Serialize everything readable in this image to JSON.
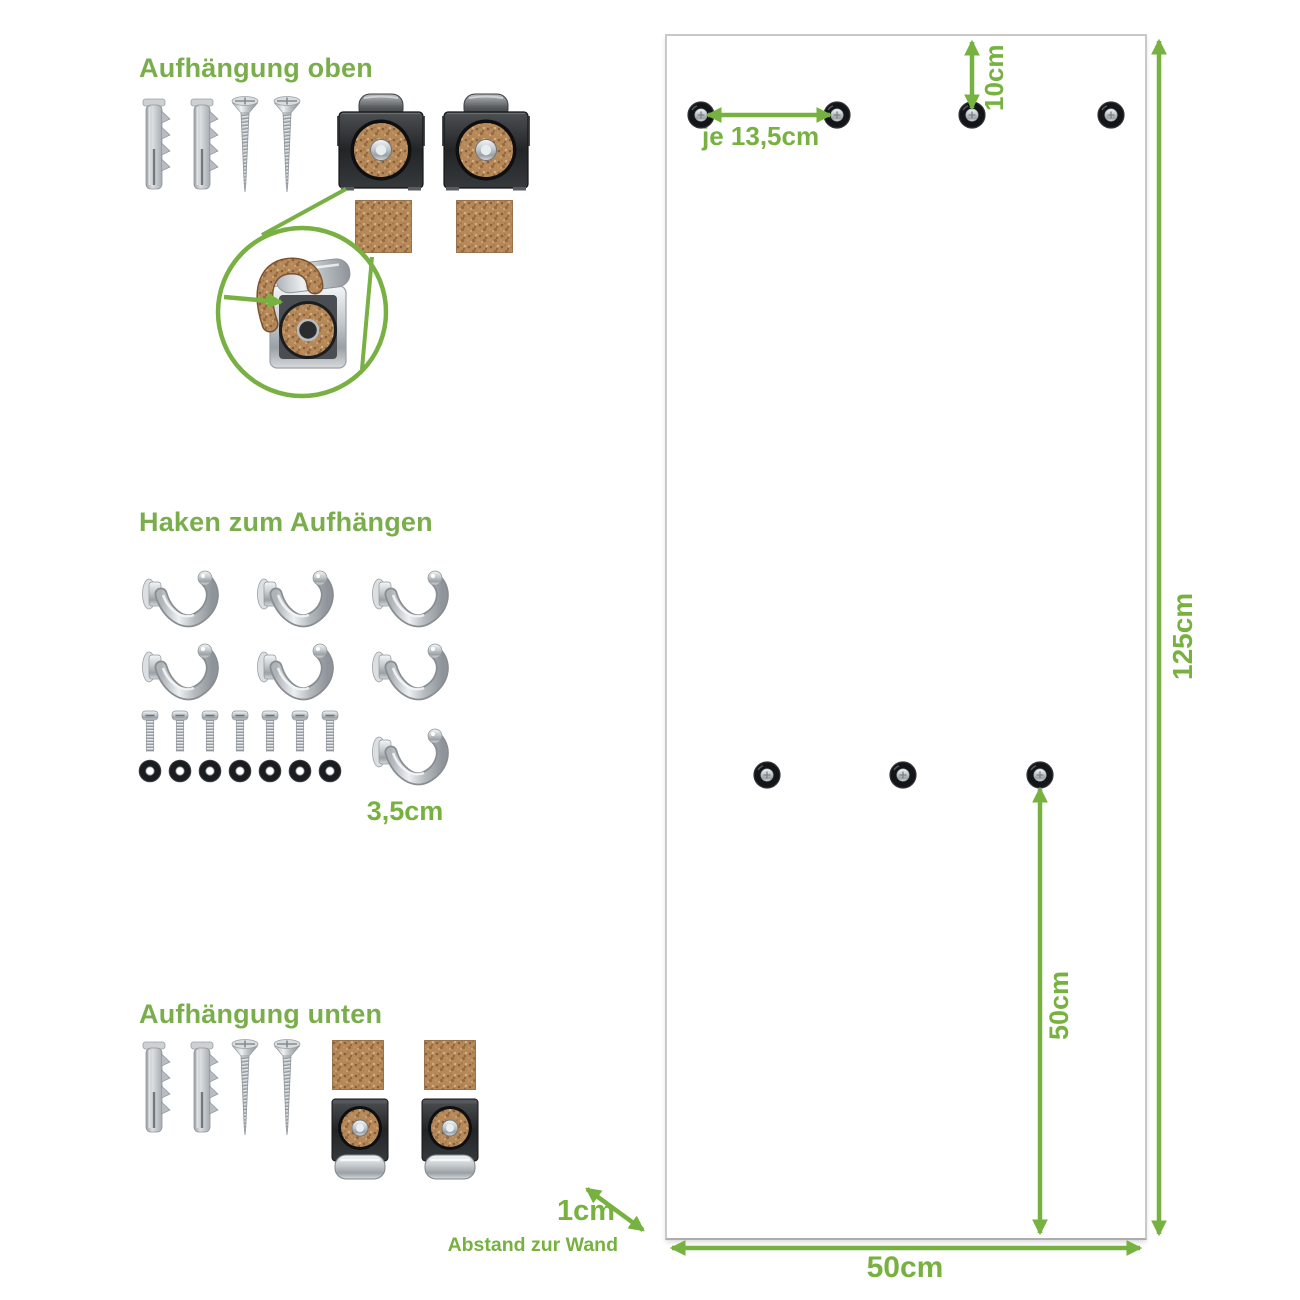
{
  "colors": {
    "accent_green": "#77b13f",
    "heading_green": "#7aad4b",
    "panel_border": "#c9c9c9",
    "cork": "#b5895a",
    "metal_dark": "#232426",
    "chrome": "#c3c8cc",
    "hole_black": "#141518"
  },
  "sections": {
    "top_mount": {
      "title": "Aufhängung oben",
      "items": [
        {
          "icon": "wall-plug-icon",
          "count": 2
        },
        {
          "icon": "screw-icon",
          "count": 2
        },
        {
          "icon": "mounting-clip-icon",
          "count": 2
        },
        {
          "icon": "cork-pad-icon",
          "count": 2
        }
      ],
      "detail": "clip-with-cork-strip-closeup"
    },
    "hooks": {
      "title": "Haken zum Aufhängen",
      "hook_count": 7,
      "bolt_count": 7,
      "washer_count": 7,
      "hook_width_label": "3,5cm"
    },
    "bottom_mount": {
      "title": "Aufhängung unten",
      "items": [
        {
          "icon": "wall-plug-icon",
          "count": 2
        },
        {
          "icon": "screw-icon",
          "count": 2
        },
        {
          "icon": "cork-pad-icon",
          "count": 2
        },
        {
          "icon": "mounting-clip-bottom-icon",
          "count": 2
        }
      ]
    }
  },
  "panel": {
    "top_hole_count": 4,
    "middle_hole_count": 3,
    "top_hole_spacing_label": "je 13,5cm",
    "top_hole_offset_label": "10cm",
    "height_label": "125cm",
    "bottom_hole_offset_label": "50cm",
    "width_label": "50cm",
    "wall_distance_value": "1cm",
    "wall_distance_caption": "Abstand zur Wand"
  }
}
